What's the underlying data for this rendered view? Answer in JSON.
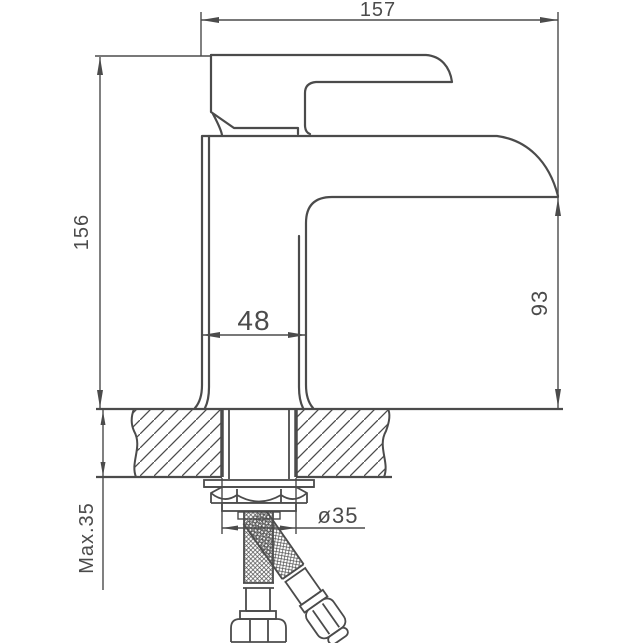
{
  "colors": {
    "line": "#4b4b4b",
    "background": "#ffffff"
  },
  "dimensions": {
    "overall_width": "157",
    "overall_height": "156",
    "body_width": "48",
    "spout_height": "93",
    "deck_thickness": "Max.35",
    "hole_diameter": "ø35"
  }
}
